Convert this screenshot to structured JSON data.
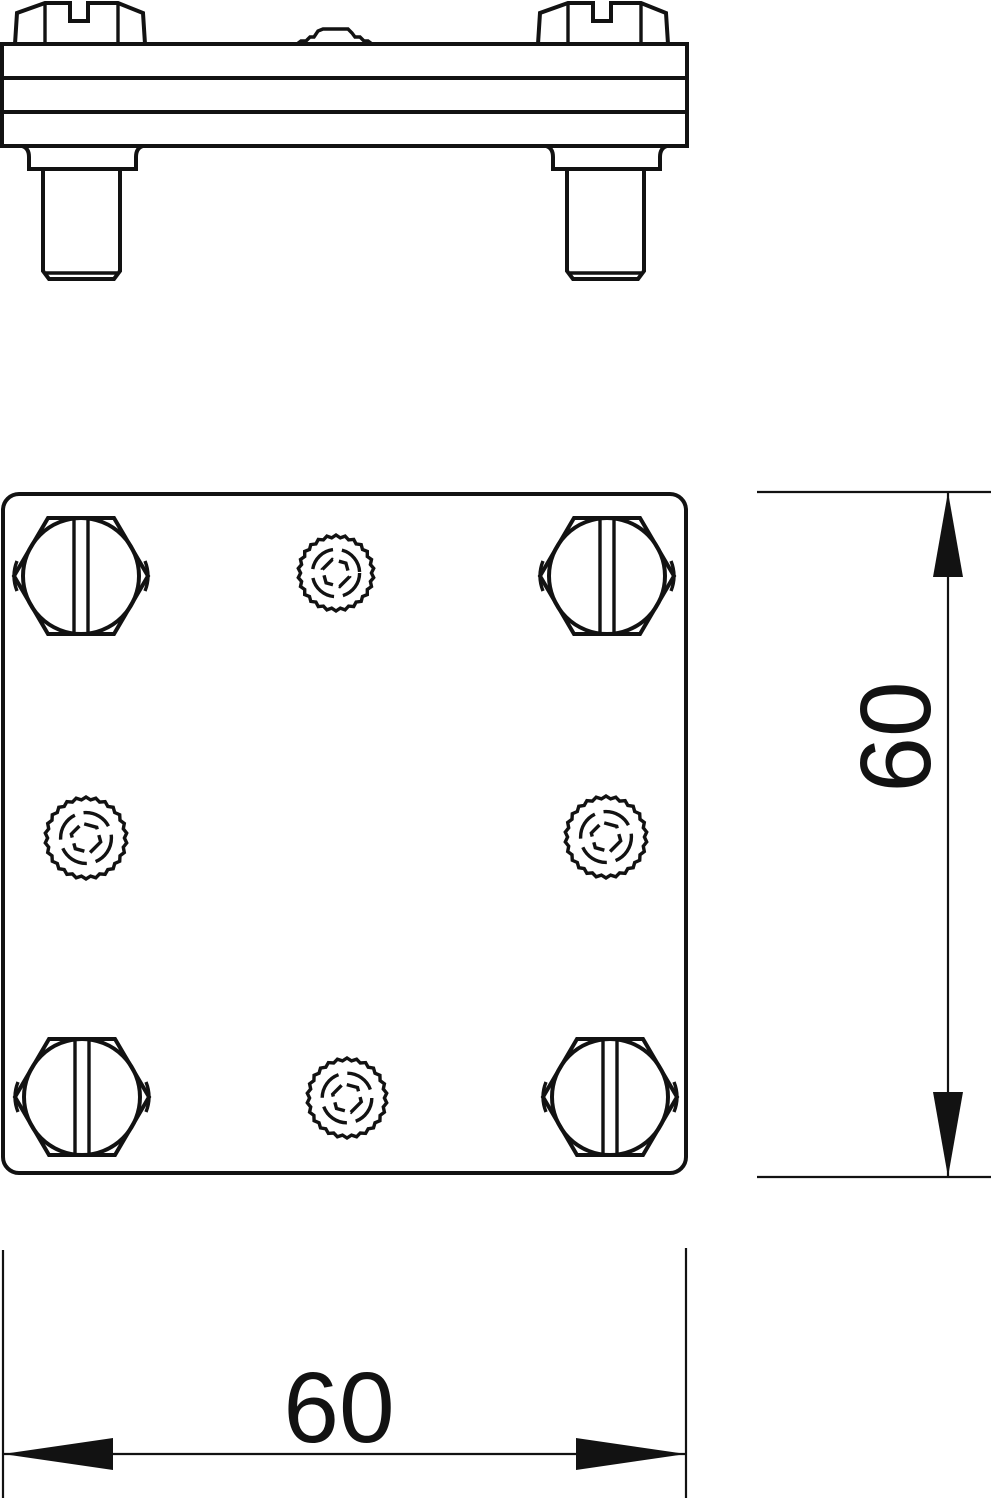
{
  "drawing": {
    "type": "technical-line-drawing",
    "subject": "cross-connector clamp — side elevation and plan view",
    "line_color": "#121212",
    "background": "#ffffff"
  },
  "plan_view": {
    "hex_bolts": [
      {
        "cx": 81,
        "cy": 576
      },
      {
        "cx": 607,
        "cy": 576
      },
      {
        "cx": 82,
        "cy": 1097
      },
      {
        "cx": 610,
        "cy": 1097
      }
    ],
    "knurls": [
      {
        "cx": 336,
        "cy": 573,
        "r": 38
      },
      {
        "cx": 86,
        "cy": 838,
        "r": 41
      },
      {
        "cx": 606,
        "cy": 837,
        "r": 41
      },
      {
        "cx": 347,
        "cy": 1098,
        "r": 40
      }
    ]
  },
  "dimensions": {
    "height": {
      "value": "60",
      "orientation": "vertical"
    },
    "width": {
      "value": "60",
      "orientation": "horizontal"
    }
  }
}
